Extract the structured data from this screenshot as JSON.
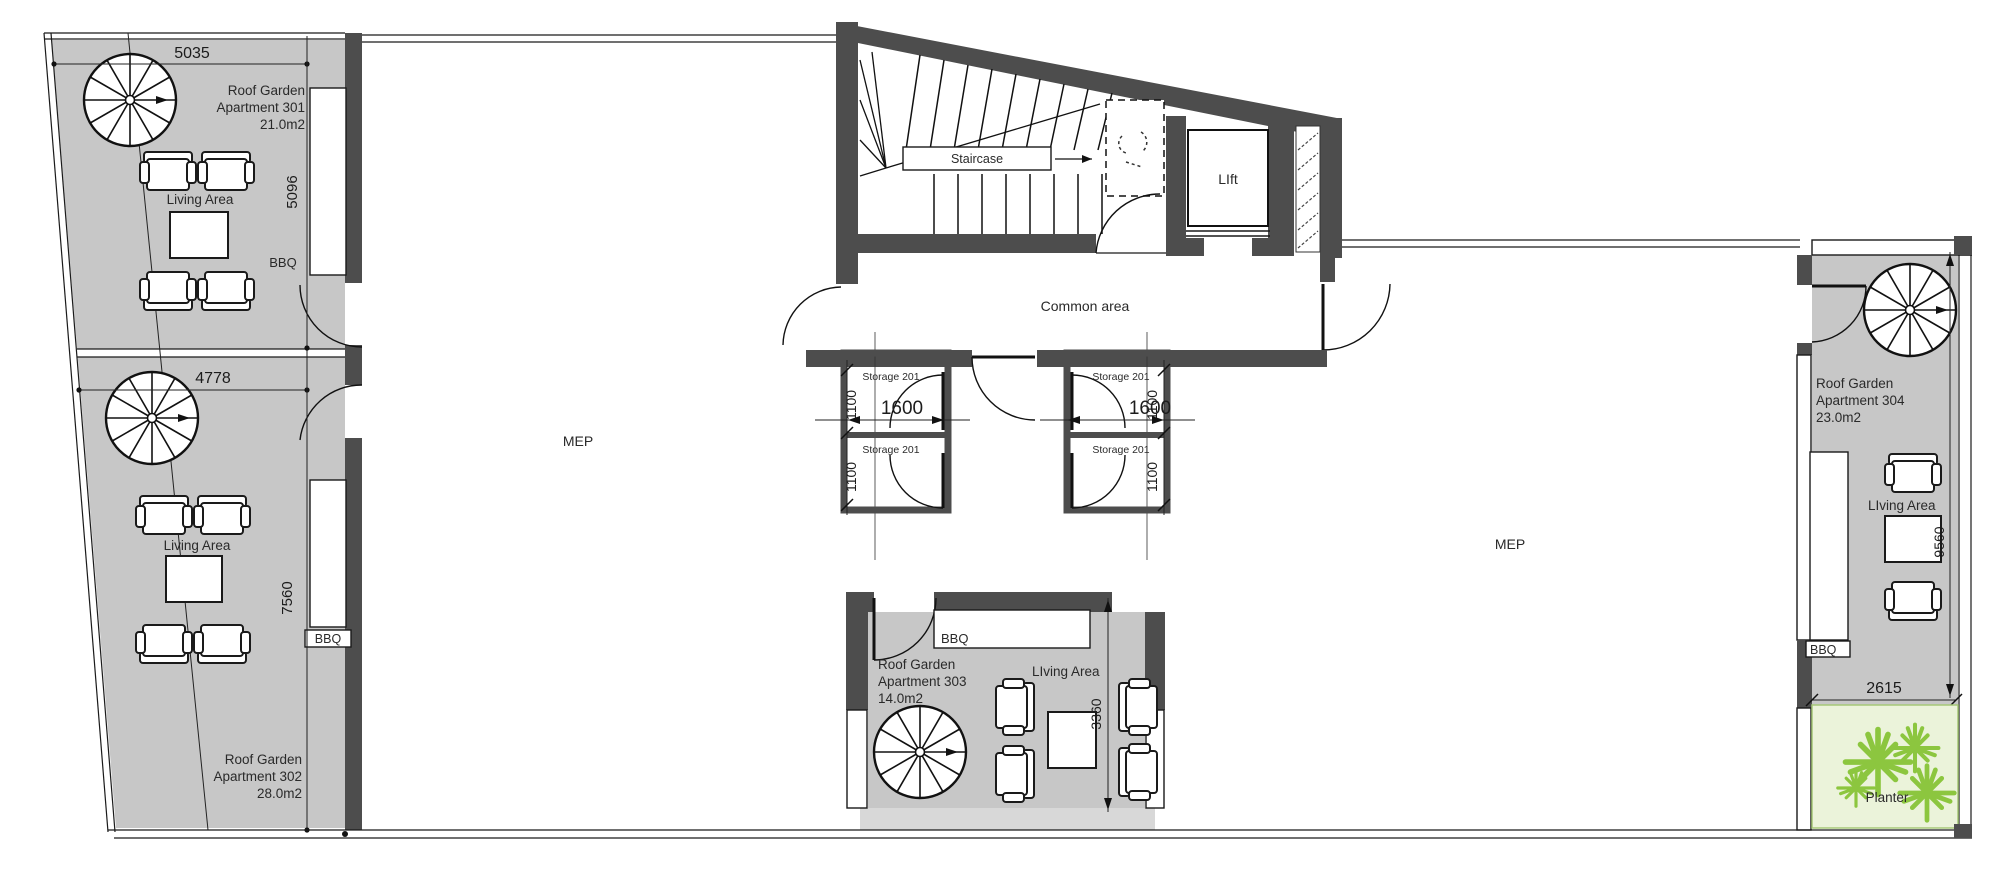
{
  "colors": {
    "wall": "#4d4d4d",
    "apartment_fill": "#c7c7c7",
    "planter_fill": "#ebf3da",
    "plant_green": "#8cc63f"
  },
  "apartments": {
    "a301": {
      "name": [
        "Roof Garden",
        "Apartment 301",
        "21.0m2"
      ],
      "living_area": "Living Area",
      "bbq": "BBQ"
    },
    "a302": {
      "name": [
        "Roof Garden",
        "Apartment 302",
        "28.0m2"
      ],
      "living_area": "Living Area",
      "bbq": "BBQ"
    },
    "a303": {
      "name": [
        "Roof Garden",
        "Apartment 303",
        "14.0m2"
      ],
      "living_area": "LIving Area",
      "bbq": "BBQ"
    },
    "a304": {
      "name": [
        "Roof Garden",
        "Apartment 304",
        "23.0m2"
      ],
      "living_area": "LIving Area",
      "bbq": "BBQ"
    }
  },
  "core": {
    "staircase": "Staircase",
    "lift": "LIft",
    "common_area": "Common area"
  },
  "storage": {
    "label": "Storage 201"
  },
  "mep": {
    "label": "MEP"
  },
  "planter": {
    "label": "Planter"
  },
  "dimensions": {
    "apt301_width": "5035",
    "apt301_height": "5096",
    "apt302_width": "4778",
    "apt302_height": "7560",
    "storage_height": "1100",
    "storage_width": "1600",
    "apt303_height": "3360",
    "apt304_height": "9560",
    "apt304_width": "2615"
  }
}
